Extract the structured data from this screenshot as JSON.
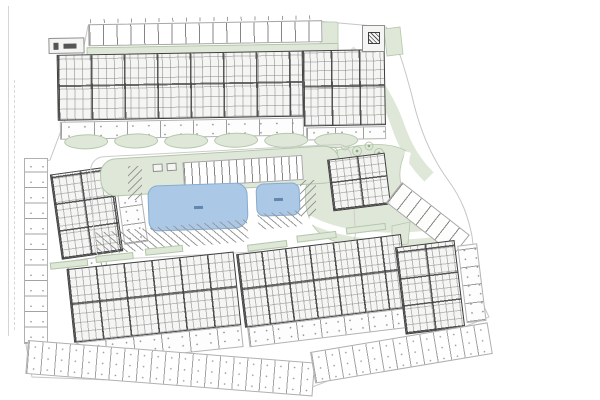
{
  "document": {
    "type": "architectural site plan",
    "title": "Residential development master plan",
    "labels_legible": false
  },
  "colors": {
    "paper": "#ffffff",
    "line_faint": "#c9c9c9",
    "line_mid": "#9b9b9b",
    "wall_dark": "#3e3e3e",
    "green_fill": "#dfe8d8",
    "green_line": "#b4c7aa",
    "pool_fill": "#abc9e6",
    "pool_line": "#86abce",
    "pool_text": "#4a6f9b"
  },
  "site": {
    "north_block": {
      "name": "north apartment block",
      "units": 10,
      "street_parking_stalls": 17,
      "garden_plots": 8
    },
    "west_block": {
      "name": "west apartment block",
      "units": 4
    },
    "clubhouse": {
      "name": "clubhouse building"
    },
    "utility": {
      "name": "utility kiosk"
    },
    "pools": [
      {
        "name": "main pool"
      },
      {
        "name": "small pool"
      }
    ],
    "central_parking": {
      "island_stalls": 16,
      "hatched_stalls": 20
    },
    "east_parking_fan": {
      "stalls": 7
    },
    "southwest_block": {
      "name": "south-west apartment block",
      "units": 6
    },
    "south_block": {
      "name": "south apartment block",
      "units": 7
    },
    "southeast_block": {
      "name": "south-east apartment block",
      "units": 4
    },
    "perimeter_plots": {
      "west_strip": 12,
      "south_strip_west": 21,
      "south_strip_east": 13
    },
    "landscape": {
      "trees": 5,
      "hedge_mounds": 6
    }
  }
}
